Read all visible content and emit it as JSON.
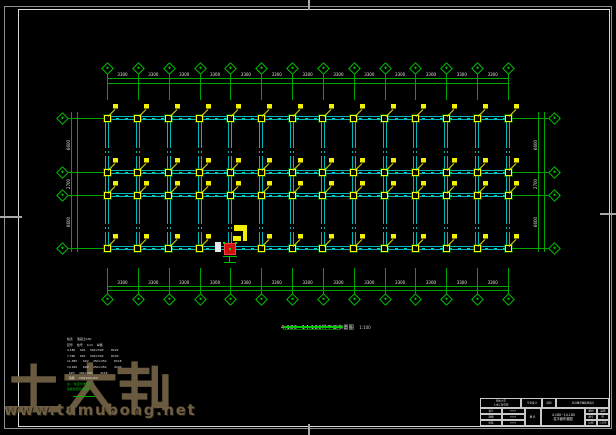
{
  "colors": {
    "background": "#000000",
    "grid_green": "#00a400",
    "beam_cyan": "#00b8b8",
    "column_yellow": "#ffff00",
    "dim_text": "#e0e0e0",
    "selection_red": "#cf1010",
    "watermark_tan": "#6f5f43",
    "frame_gray": "#8f8f8f",
    "frame_white": "#d9d9d9"
  },
  "watermark": {
    "brand": "土木帮",
    "site": "www.tumubong.net"
  },
  "plan": {
    "vertical_axes_count": 14,
    "horizontal_axes_count": 4,
    "bay_dim_label": "3300",
    "row_depth_labels": [
      "6600",
      "2700",
      "6600"
    ]
  },
  "caption": {
    "title": "4.180~14.180柱平面布置图",
    "scale": "1:100"
  },
  "notes": {
    "white_rows": [
      [
        "柱表",
        "混凝土C30"
      ],
      [
        "层号",
        "柱号",
        "b×h",
        "纵筋"
      ],
      [
        "4.180",
        "KZ1",
        "500×500",
        "8C22"
      ],
      [
        "7.780",
        "KZ1",
        "500×500",
        "8C20"
      ],
      [
        "11.380",
        "KZ2",
        "450×450",
        "8C18"
      ],
      [
        "14.180",
        "KZ2",
        "450×450",
        "4C20"
      ],
      [
        "",
        "KZ3",
        "400×400",
        "4C18"
      ],
      [
        "",
        "箍筋",
        "C8@100/200",
        ""
      ]
    ],
    "green_rows": [
      [
        "注:",
        "柱定位详建施"
      ],
      [
        "箍筋加密区详图集"
      ]
    ]
  },
  "titleblock": {
    "org_line1": "郑州大学",
    "org_line2": "土木工程学院",
    "project_type": "毕业设计",
    "discipline": "结构",
    "project_name": "综合教学楼结构设计",
    "sign_rows": [
      [
        "设计",
        "×××"
      ],
      [
        "制图",
        "×××"
      ],
      [
        "审核",
        "×××"
      ]
    ],
    "name_label": "图 名",
    "drawing_title_line1": "4.180~14.180",
    "drawing_title_line2": "柱平面布置图",
    "meta_rows": [
      [
        "图别",
        "结施"
      ],
      [
        "图号",
        "05"
      ],
      [
        "比例",
        "1:100"
      ]
    ]
  }
}
